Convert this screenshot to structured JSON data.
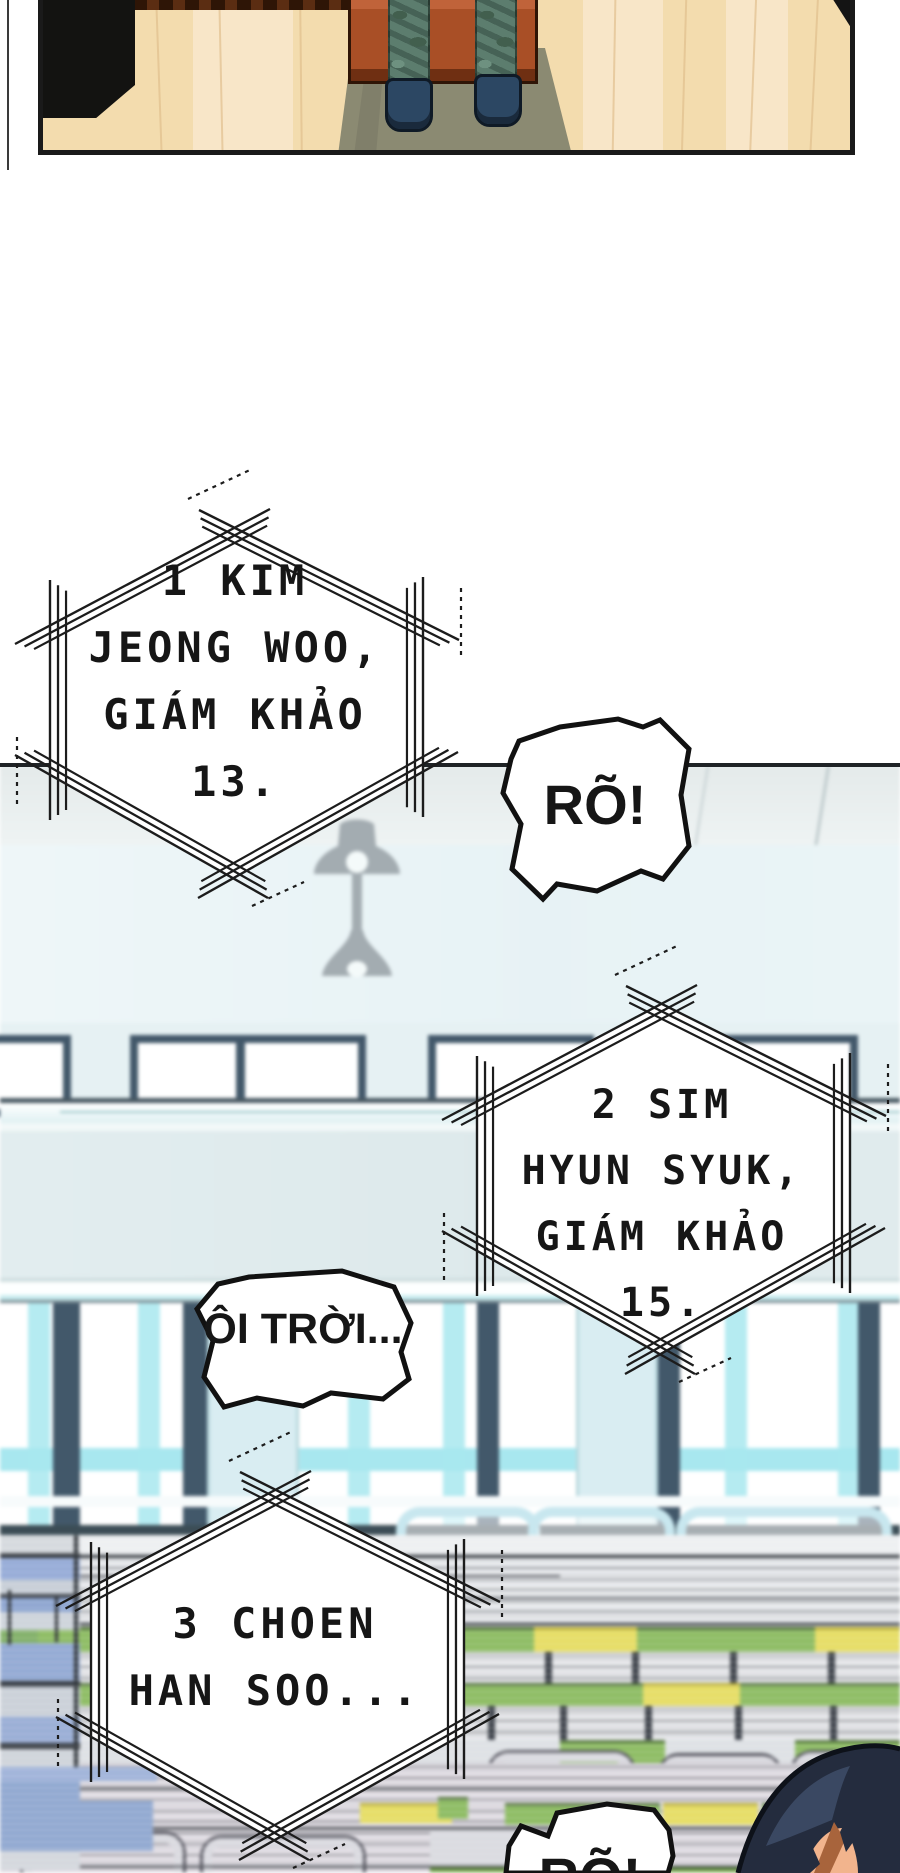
{
  "page": {
    "kind": "webtoon comic page",
    "language": "Vietnamese"
  },
  "bubbles": {
    "judge1": {
      "shape": "hexagon-shout",
      "lines": [
        "1 KIM",
        "JEONG WOO,",
        "GIÁM KHẢO",
        "13."
      ]
    },
    "reply1": {
      "shape": "burst",
      "text": "RÕ!"
    },
    "judge2": {
      "shape": "hexagon-shout",
      "lines": [
        "2 SIM",
        "HYUN SYUK,",
        "GIÁM KHẢO",
        "15."
      ]
    },
    "reaction1": {
      "shape": "blob",
      "text": "ÔI TRỜI..."
    },
    "judge3": {
      "shape": "hexagon-shout",
      "lines": [
        "3 CHOEN",
        "HAN SOO..."
      ]
    },
    "reply2": {
      "shape": "burst",
      "text": "RÕ!"
    }
  },
  "colors": {
    "wood": "#f3dcae",
    "wood_hi": "#f9ead0",
    "wood_line": "#dfbd8a",
    "table": "#a94f26",
    "table_dark": "#6f2f12",
    "camo": "#5c7d6e",
    "camo_dark": "#425f4e",
    "shoe": "#2c4763",
    "shadow": "#8b8a72",
    "ink": "#1c1c1c",
    "ceiling": "#e4eaea",
    "wall": "#ebf5f7",
    "frame_dark": "#42586a",
    "glass_cyan": "#a8e7ef",
    "pillar": "#d9edf2",
    "seat_green": "#8aba5f",
    "seat_yellow": "#e5dc60",
    "chair_blue": "#93a9d6",
    "tube_silver": "#d9d9df",
    "streak_dark": "#33383e",
    "hair": "#242c3e",
    "hair_hi": "#3d4b66",
    "skin": "#f2b48d",
    "sideburn": "#a8643c",
    "lamp": "#a3acb1"
  }
}
